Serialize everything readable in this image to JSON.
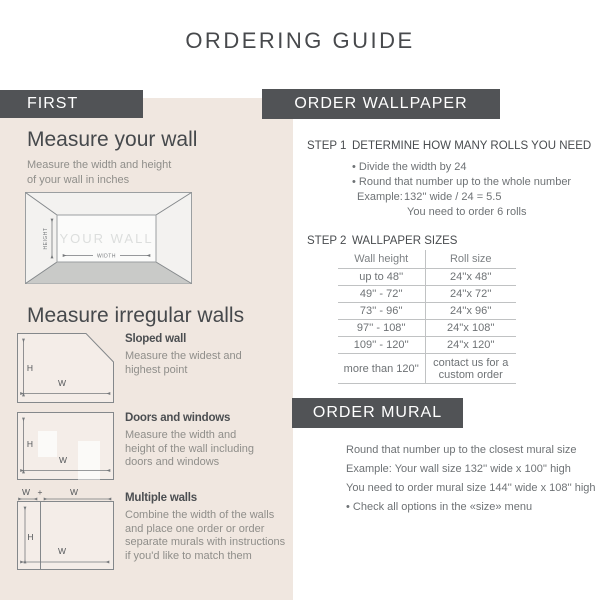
{
  "page": {
    "title": "ORDERING GUIDE"
  },
  "colors": {
    "bar_bg": "#515356",
    "panel_bg": "#f0e7e0",
    "heading_text": "#46494c",
    "body_text_left": "#8f8e8a",
    "body_text_right": "#6e7275",
    "table_border": "#c0c2c3",
    "floor_gray": "#c9cac8",
    "wall_label_gray": "#dcdedd"
  },
  "first": {
    "header": "FIRST",
    "measure_wall": {
      "heading": "Measure your wall",
      "subtitle_lines": [
        "Measure the width and height",
        "of your wall in inches"
      ],
      "diagram": {
        "wall_label": "YOUR WALL",
        "height_label": "HEIGHT",
        "width_label": "WIDTH"
      }
    },
    "irregular": {
      "heading": "Measure irregular walls",
      "items": [
        {
          "title": "Sloped wall",
          "lines": [
            "Measure the widest and",
            "highest point"
          ],
          "h_label": "H",
          "w_label": "W"
        },
        {
          "title": "Doors and windows",
          "lines": [
            "Measure the width and",
            "height of the wall including",
            "doors and windows"
          ],
          "h_label": "H",
          "w_label": "W"
        },
        {
          "title": "Multiple walls",
          "lines": [
            "Combine the width of the walls",
            "and place one order or order",
            "separate murals with instructions",
            "if you'd like to match them"
          ],
          "h_label": "H",
          "w_label": "W",
          "w1_label": "W",
          "plus_label": "+",
          "w2_label": "W"
        }
      ]
    }
  },
  "order_wallpaper": {
    "header": "ORDER WALLPAPER",
    "step1": {
      "label": "STEP 1",
      "title": "DETERMINE HOW MANY ROLLS YOU NEED",
      "bullets": [
        "• Divide the width by 24",
        "• Round that number up to the whole number"
      ],
      "example_label": "Example:",
      "example_value": "132'' wide / 24 = 5.5",
      "example_result": "You need to order 6 rolls"
    },
    "step2": {
      "label": "STEP 2",
      "title": "WALLPAPER SIZES",
      "table": {
        "col1": "Wall height",
        "col2": "Roll size",
        "rows": [
          [
            "up to 48''",
            "24''x 48''"
          ],
          [
            "49'' - 72''",
            "24''x 72''"
          ],
          [
            "73'' - 96''",
            "24''x 96''"
          ],
          [
            "97'' - 108''",
            "24''x 108''"
          ],
          [
            "109'' - 120''",
            "24''x 120''"
          ],
          [
            "more than 120''",
            "contact us for a custom order"
          ]
        ]
      }
    }
  },
  "order_mural": {
    "header": "ORDER MURAL",
    "lines": [
      "Round that number up to the closest mural size",
      "Example: Your wall size 132'' wide x 100'' high",
      "You need to order mural size 144'' wide x 108'' high",
      "• Check all options in the «size» menu"
    ]
  }
}
